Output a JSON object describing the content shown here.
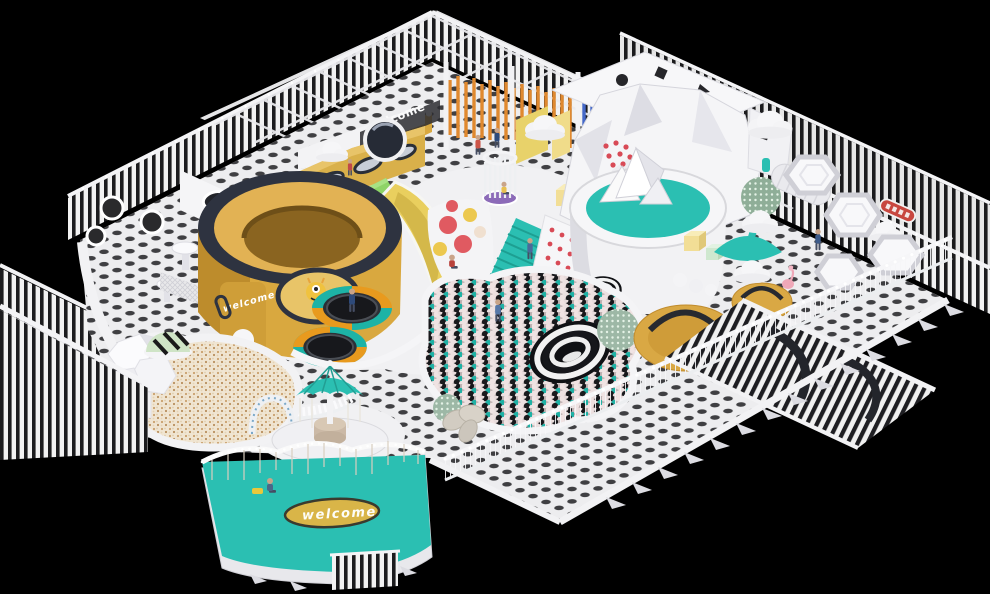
{
  "scene": {
    "subject": "isometric 3D render of an indoor children's playground",
    "background": "#000000",
    "signs": {
      "tub_welcome": "welcome",
      "wall_welcome": "welcome",
      "mat_welcome": "welcome"
    },
    "palette": {
      "teal": "#2bbfb2",
      "teal_dark": "#1d9f92",
      "gold": "#d9a83f",
      "gold_light": "#e2b254",
      "banana_yellow": "#e9cf5e",
      "navy_rim": "#2e3340",
      "stripe_black": "#1c1c1e",
      "floor_white": "#ededef",
      "floor_dot": "#3f3f42",
      "pole_orange": "#e0892f",
      "accent_red": "#d84a56",
      "mint_green": "#cfe4c6",
      "sand_cream": "#f0e5d2",
      "carousel_purple": "#8c6bb8",
      "mat_gold": "#d9b548"
    }
  }
}
